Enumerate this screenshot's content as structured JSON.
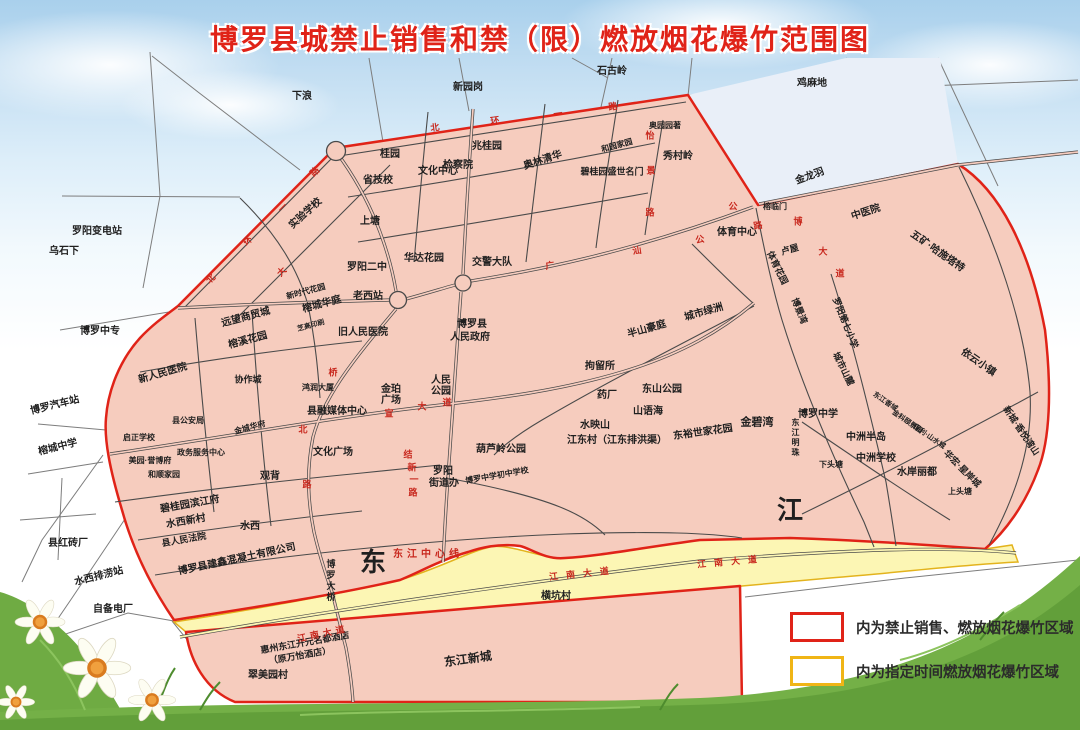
{
  "title": "博罗县城禁止销售和禁（限）燃放烟花爆竹范围图",
  "colors": {
    "title_red": "#e02318",
    "prohibited_border": "#e02318",
    "prohibited_fill": "#f6ccbe",
    "designated_border": "#f0b516",
    "designated_fill": "#fcf6b4",
    "road_label_red": "#c8281e",
    "sky": "#a9d0ec",
    "grass": "#6aa93f"
  },
  "legend": [
    {
      "swatch": "red",
      "label": "内为禁止销售、燃放烟花爆竹区域"
    },
    {
      "swatch": "yellow",
      "label": "内为指定时间燃放烟花爆竹区域"
    }
  ],
  "map": {
    "labels": [
      {
        "t": "下浪",
        "x": 302,
        "y": 97
      },
      {
        "t": "新园岗",
        "x": 468,
        "y": 88
      },
      {
        "t": "石古岭",
        "x": 612,
        "y": 72
      },
      {
        "t": "鸡麻地",
        "x": 812,
        "y": 84
      },
      {
        "t": "罗阳变电站",
        "x": 97,
        "y": 232
      },
      {
        "t": "乌石下",
        "x": 64,
        "y": 252
      },
      {
        "t": "博罗中专",
        "x": 100,
        "y": 332
      },
      {
        "t": "博罗汽车站",
        "x": 55,
        "y": 406,
        "r": -14
      },
      {
        "t": "榕城中学",
        "x": 58,
        "y": 448,
        "r": -14
      },
      {
        "t": "县红砖厂",
        "x": 68,
        "y": 544
      },
      {
        "t": "水西排涝站",
        "x": 99,
        "y": 577,
        "r": -14
      },
      {
        "t": "自备电厂",
        "x": 113,
        "y": 610
      },
      {
        "t": "翠美园村",
        "x": 268,
        "y": 676
      },
      {
        "t": "横坑村",
        "x": 556,
        "y": 597
      },
      {
        "t": "金龙羽",
        "x": 810,
        "y": 177,
        "r": -20
      },
      {
        "t": "榕临门",
        "x": 775,
        "y": 207,
        "s": 8
      },
      {
        "t": "中医院",
        "x": 866,
        "y": 213,
        "r": -18
      },
      {
        "t": "桂园",
        "x": 390,
        "y": 155
      },
      {
        "t": "省技校",
        "x": 378,
        "y": 181
      },
      {
        "t": "文化中心",
        "x": 438,
        "y": 172
      },
      {
        "t": "兆桂园",
        "x": 487,
        "y": 147
      },
      {
        "t": "检察院",
        "x": 458,
        "y": 166
      },
      {
        "t": "奥林清华",
        "x": 543,
        "y": 161,
        "r": -18
      },
      {
        "t": "和园家园",
        "x": 617,
        "y": 146,
        "s": 8,
        "r": -15
      },
      {
        "t": "奥园园著",
        "x": 665,
        "y": 126,
        "s": 8
      },
      {
        "t": "碧桂园盛世名门",
        "x": 612,
        "y": 172,
        "s": 9
      },
      {
        "t": "秀村岭",
        "x": 678,
        "y": 157
      },
      {
        "t": "实验学校",
        "x": 306,
        "y": 214,
        "r": -42
      },
      {
        "t": "上塘",
        "x": 370,
        "y": 222
      },
      {
        "t": "罗阳二中",
        "x": 367,
        "y": 268
      },
      {
        "t": "华达花园",
        "x": 424,
        "y": 259
      },
      {
        "t": "老西站",
        "x": 368,
        "y": 297
      },
      {
        "t": "新时代花园",
        "x": 306,
        "y": 292,
        "s": 8,
        "r": -15
      },
      {
        "t": "榕城华庭",
        "x": 322,
        "y": 305,
        "r": -15
      },
      {
        "t": "远望商贸城",
        "x": 246,
        "y": 318,
        "r": -15
      },
      {
        "t": "榕溪花园",
        "x": 248,
        "y": 341,
        "r": -15
      },
      {
        "t": "芝高印刷",
        "x": 311,
        "y": 326,
        "s": 7,
        "r": -15
      },
      {
        "t": "旧人民医院",
        "x": 363,
        "y": 333
      },
      {
        "t": "新人民医院",
        "x": 163,
        "y": 374,
        "r": -16
      },
      {
        "t": "协作城",
        "x": 248,
        "y": 380,
        "s": 9
      },
      {
        "t": "县公安局",
        "x": 188,
        "y": 421,
        "s": 8
      },
      {
        "t": "启正学校",
        "x": 139,
        "y": 438,
        "s": 8
      },
      {
        "t": "美园·誉博府",
        "x": 150,
        "y": 461,
        "s": 8
      },
      {
        "t": "政务服务中心",
        "x": 201,
        "y": 453,
        "s": 8
      },
      {
        "t": "和顺家园",
        "x": 164,
        "y": 475,
        "s": 8
      },
      {
        "t": "金城华府",
        "x": 250,
        "y": 428,
        "s": 8,
        "r": -15
      },
      {
        "t": "县融媒体中心",
        "x": 337,
        "y": 412
      },
      {
        "t": "鸿润大厦",
        "x": 318,
        "y": 388,
        "s": 8
      },
      {
        "t": "金珀",
        "x": 391,
        "y": 390
      },
      {
        "t": "广场",
        "x": 391,
        "y": 401
      },
      {
        "t": "人民",
        "x": 441,
        "y": 381
      },
      {
        "t": "公园",
        "x": 441,
        "y": 392
      },
      {
        "t": "文化广场",
        "x": 333,
        "y": 453
      },
      {
        "t": "观背",
        "x": 270,
        "y": 477
      },
      {
        "t": "碧桂园滨江府",
        "x": 190,
        "y": 505,
        "r": -10
      },
      {
        "t": "水西新村",
        "x": 186,
        "y": 522,
        "r": -10
      },
      {
        "t": "县人民法院",
        "x": 184,
        "y": 540,
        "r": -10,
        "s": 9
      },
      {
        "t": "水西",
        "x": 250,
        "y": 527
      },
      {
        "t": "博罗县建鑫混凝土有限公司",
        "x": 237,
        "y": 560,
        "r": -12
      },
      {
        "t": "罗阳",
        "x": 443,
        "y": 472
      },
      {
        "t": "街道办",
        "x": 444,
        "y": 484
      },
      {
        "t": "葫芦岭公园",
        "x": 501,
        "y": 450
      },
      {
        "t": "博罗中学初中学校",
        "x": 497,
        "y": 476,
        "s": 8,
        "r": -10
      },
      {
        "t": "博罗县",
        "x": 472,
        "y": 325
      },
      {
        "t": "人民政府",
        "x": 470,
        "y": 338
      },
      {
        "t": "交警大队",
        "x": 492,
        "y": 263
      },
      {
        "t": "拘留所",
        "x": 600,
        "y": 367
      },
      {
        "t": "半山豪庭",
        "x": 647,
        "y": 330,
        "r": -16
      },
      {
        "t": "城市绿洲",
        "x": 704,
        "y": 313,
        "r": -16
      },
      {
        "t": "东山公园",
        "x": 662,
        "y": 390
      },
      {
        "t": "药厂",
        "x": 607,
        "y": 396
      },
      {
        "t": "山语海",
        "x": 648,
        "y": 412
      },
      {
        "t": "水映山",
        "x": 595,
        "y": 426
      },
      {
        "t": "江东村（江东排洪渠）",
        "x": 617,
        "y": 441
      },
      {
        "t": "东裕世家花园",
        "x": 703,
        "y": 433,
        "r": -8
      },
      {
        "t": "金碧湾",
        "x": 757,
        "y": 423,
        "s": 11,
        "b": 1
      },
      {
        "t": "体育中心",
        "x": 737,
        "y": 233
      },
      {
        "t": "卢屋",
        "x": 790,
        "y": 250,
        "r": -16,
        "s": 9
      },
      {
        "t": "体育花园",
        "x": 777,
        "y": 268,
        "r": 64,
        "s": 9
      },
      {
        "t": "博景湾",
        "x": 799,
        "y": 311,
        "r": 68,
        "s": 9
      },
      {
        "t": "罗阳第七小学",
        "x": 845,
        "y": 323,
        "r": 68,
        "s": 9
      },
      {
        "t": "城市山麓",
        "x": 843,
        "y": 369,
        "r": 64,
        "s": 9
      },
      {
        "t": "博罗中学",
        "x": 818,
        "y": 415
      },
      {
        "t": "东江明珠",
        "x": 795,
        "y": 438,
        "s": 8,
        "v": 1
      },
      {
        "t": "东江香域",
        "x": 885,
        "y": 402,
        "s": 7,
        "r": 35
      },
      {
        "t": "金科颐景园",
        "x": 907,
        "y": 422,
        "s": 7,
        "r": 35
      },
      {
        "t": "保利·山水城",
        "x": 929,
        "y": 437,
        "s": 7,
        "r": 35
      },
      {
        "t": "依云小镇",
        "x": 978,
        "y": 363,
        "r": 35
      },
      {
        "t": "五矿·哈施塔特",
        "x": 937,
        "y": 252,
        "r": 35
      },
      {
        "t": "新城·香悦湾山",
        "x": 1021,
        "y": 431,
        "r": 56,
        "s": 9
      },
      {
        "t": "华宏·星岸城",
        "x": 962,
        "y": 469,
        "r": 45,
        "s": 9
      },
      {
        "t": "中洲半岛",
        "x": 866,
        "y": 438
      },
      {
        "t": "中洲学校",
        "x": 876,
        "y": 459
      },
      {
        "t": "水岸丽都",
        "x": 917,
        "y": 473
      },
      {
        "t": "下头塘",
        "x": 831,
        "y": 465,
        "s": 8
      },
      {
        "t": "上头塘",
        "x": 960,
        "y": 492,
        "s": 8
      },
      {
        "t": "博罗大桥",
        "x": 330,
        "y": 581,
        "s": 9,
        "v": 1
      },
      {
        "t": "东",
        "x": 373,
        "y": 562,
        "s": 26,
        "b": 1
      },
      {
        "t": "江",
        "x": 790,
        "y": 510,
        "s": 26,
        "b": 1
      },
      {
        "t": "惠州东江开元名都酒店",
        "x": 305,
        "y": 643,
        "r": -10,
        "s": 9
      },
      {
        "t": "（原万怡酒店）",
        "x": 300,
        "y": 656,
        "r": -10,
        "s": 9
      },
      {
        "t": "东江新城",
        "x": 468,
        "y": 659,
        "r": -8,
        "s": 12
      },
      {
        "t": "北",
        "x": 435,
        "y": 128,
        "c": 1,
        "r": -8
      },
      {
        "t": "环",
        "x": 495,
        "y": 121,
        "c": 1,
        "r": -8
      },
      {
        "t": "一",
        "x": 558,
        "y": 114,
        "c": 1,
        "r": -8
      },
      {
        "t": "路",
        "x": 613,
        "y": 107,
        "c": 1,
        "r": -8
      },
      {
        "t": "怡",
        "x": 650,
        "y": 136,
        "c": 1
      },
      {
        "t": "景",
        "x": 651,
        "y": 171,
        "c": 1
      },
      {
        "t": "路",
        "x": 650,
        "y": 213,
        "c": 1
      },
      {
        "t": "路",
        "x": 315,
        "y": 172,
        "c": 1,
        "r": -45
      },
      {
        "t": "环",
        "x": 248,
        "y": 241,
        "c": 1,
        "r": -45
      },
      {
        "t": "北",
        "x": 211,
        "y": 279,
        "c": 1,
        "r": -45
      },
      {
        "t": "一",
        "x": 283,
        "y": 208,
        "c": 1,
        "r": -45
      },
      {
        "t": "大",
        "x": 282,
        "y": 272,
        "c": 1,
        "r": -45
      },
      {
        "t": "广",
        "x": 550,
        "y": 266,
        "c": 1,
        "r": -8
      },
      {
        "t": "汕",
        "x": 637,
        "y": 251,
        "c": 1,
        "r": -8
      },
      {
        "t": "公",
        "x": 700,
        "y": 240,
        "c": 1,
        "r": -10
      },
      {
        "t": "路",
        "x": 758,
        "y": 226,
        "c": 1,
        "r": -10
      },
      {
        "t": "公",
        "x": 733,
        "y": 207,
        "c": 1
      },
      {
        "t": "桥",
        "x": 333,
        "y": 373,
        "c": 1
      },
      {
        "t": "北",
        "x": 303,
        "y": 430,
        "c": 1
      },
      {
        "t": "路",
        "x": 307,
        "y": 485,
        "c": 1
      },
      {
        "t": "宣",
        "x": 389,
        "y": 414,
        "c": 1
      },
      {
        "t": "大",
        "x": 422,
        "y": 407,
        "c": 1
      },
      {
        "t": "道",
        "x": 447,
        "y": 403,
        "c": 1
      },
      {
        "t": "结",
        "x": 408,
        "y": 455,
        "c": 1
      },
      {
        "t": "新",
        "x": 412,
        "y": 468,
        "c": 1
      },
      {
        "t": "一",
        "x": 414,
        "y": 480,
        "c": 1
      },
      {
        "t": "路",
        "x": 413,
        "y": 493,
        "c": 1
      },
      {
        "t": "博",
        "x": 798,
        "y": 222,
        "c": 1
      },
      {
        "t": "大",
        "x": 823,
        "y": 252,
        "c": 1
      },
      {
        "t": "道",
        "x": 840,
        "y": 274,
        "c": 1
      },
      {
        "t": "东江中心线",
        "x": 428,
        "y": 555,
        "c": 1,
        "s": 10,
        "ls": 4
      },
      {
        "t": "江南大道",
        "x": 583,
        "y": 574,
        "c": 1,
        "r": -6,
        "ls": 8
      },
      {
        "t": "江南大道",
        "x": 731,
        "y": 562,
        "c": 1,
        "r": -5,
        "ls": 8
      },
      {
        "t": "江南大道",
        "x": 323,
        "y": 634,
        "c": 1,
        "r": -12,
        "ls": 4
      }
    ]
  }
}
